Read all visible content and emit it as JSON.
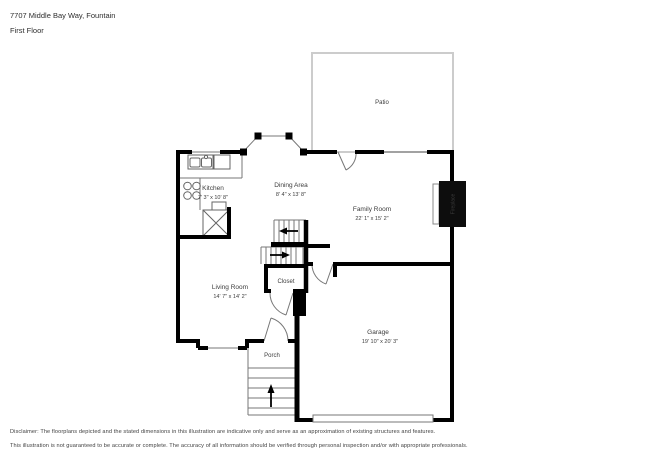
{
  "header": {
    "address": "7707 Middle Bay Way, Fountain",
    "floor": "First Floor"
  },
  "rooms": {
    "patio": {
      "label": "Patio"
    },
    "kitchen": {
      "label": "Kitchen",
      "dims": "7' 3\" x 10' 8\""
    },
    "dining_area": {
      "label": "Dining Area",
      "dims": "8' 4\" x 13' 8\""
    },
    "family_room": {
      "label": "Family Room",
      "dims": "22' 1\" x 15' 2\""
    },
    "living_room": {
      "label": "Living Room",
      "dims": "14' 7\" x 14' 2\""
    },
    "garage": {
      "label": "Garage",
      "dims": "19' 10\" x 20' 3\""
    },
    "closet": {
      "label": "Closet"
    },
    "porch": {
      "label": "Porch"
    },
    "fireplace": {
      "label": "Fireplace"
    }
  },
  "footer": {
    "line1": "Disclaimer: The floorplans depicted and the stated dimensions in this illustration are indicative only and serve as an approximation of existing structures and features.",
    "line2": "This illustration is not guaranteed to be accurate or complete. The accuracy of all information should be verified through personal inspection and/or with appropriate professionals."
  },
  "colors": {
    "wall": "#000000",
    "thin_line": "#777777",
    "patio_border": "#cccccc",
    "label_text": "#3c3c3c",
    "fireplace_fill": "#0d0d0d",
    "fireplace_text": "#ffffff"
  }
}
